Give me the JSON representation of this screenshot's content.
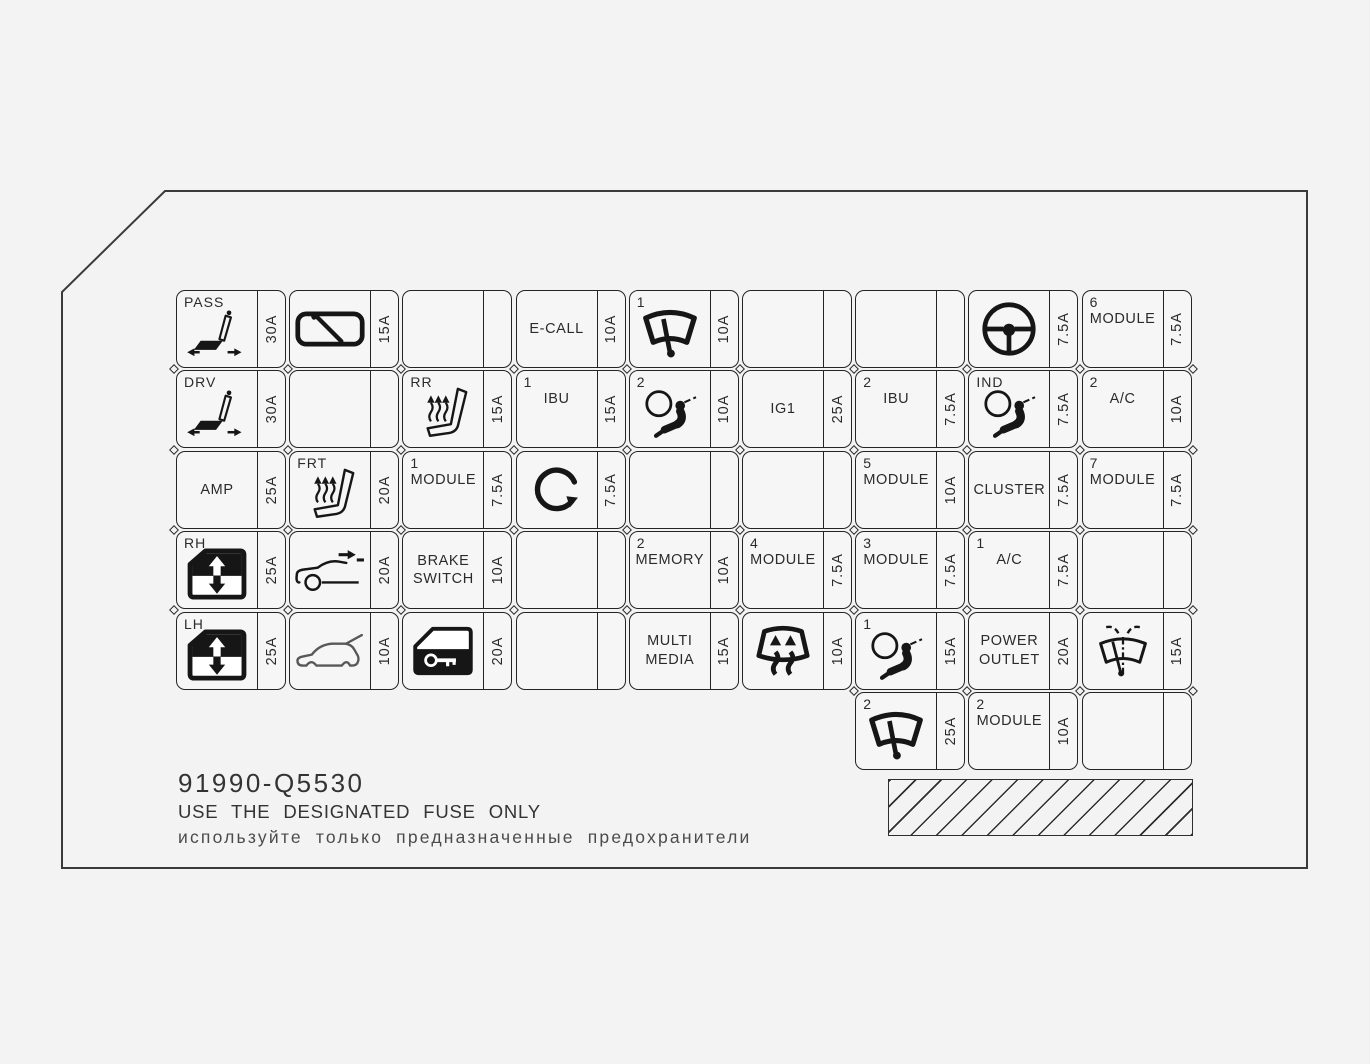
{
  "footer": {
    "part_number": "91990-Q5530",
    "warning_en": "USE THE DESIGNATED FUSE ONLY",
    "warning_ru": "используйте только предназначенные предохранители"
  },
  "colors": {
    "line": "#2a2a2a",
    "background": "#f3f3f4"
  },
  "fuse_grid": {
    "columns": 9,
    "rows": [
      {
        "cells": [
          {
            "col": 1,
            "tag": "PASS",
            "icon": "power-seat-icon",
            "amp": "30A"
          },
          {
            "col": 2,
            "icon": "wiper-blade-icon",
            "amp": "15A"
          },
          {
            "col": 3,
            "amp": ""
          },
          {
            "col": 4,
            "label": "E-CALL",
            "amp": "10A"
          },
          {
            "col": 5,
            "tag": "1",
            "icon": "front-wiper-icon",
            "amp": "10A"
          },
          {
            "col": 6,
            "amp": ""
          },
          {
            "col": 7,
            "amp": ""
          },
          {
            "col": 8,
            "icon": "steering-wheel-icon",
            "amp": "7.5A"
          },
          {
            "col": 9,
            "tag": "6",
            "label": "MODULE",
            "amp": "7.5A"
          }
        ]
      },
      {
        "cells": [
          {
            "col": 1,
            "tag": "DRV",
            "icon": "power-seat-icon",
            "amp": "30A"
          },
          {
            "col": 2,
            "amp": ""
          },
          {
            "col": 3,
            "tag": "RR",
            "icon": "heated-seat-icon",
            "amp": "15A"
          },
          {
            "col": 4,
            "tag": "1",
            "label": "IBU",
            "amp": "15A"
          },
          {
            "col": 5,
            "tag": "2",
            "icon": "airbag-icon",
            "amp": "10A"
          },
          {
            "col": 6,
            "label": "IG1",
            "amp": "25A"
          },
          {
            "col": 7,
            "tag": "2",
            "label": "IBU",
            "amp": "7.5A"
          },
          {
            "col": 8,
            "tag": "IND",
            "icon": "airbag-icon",
            "amp": "7.5A"
          },
          {
            "col": 9,
            "tag": "2",
            "label": "A/C",
            "amp": "10A"
          }
        ]
      },
      {
        "cells": [
          {
            "col": 1,
            "label": "AMP",
            "amp": "25A"
          },
          {
            "col": 2,
            "tag": "FRT",
            "icon": "heated-seat-icon",
            "amp": "20A"
          },
          {
            "col": 3,
            "tag": "1",
            "label": "MODULE",
            "amp": "7.5A"
          },
          {
            "col": 4,
            "icon": "rotation-arrow-icon",
            "amp": "7.5A"
          },
          {
            "col": 5,
            "amp": ""
          },
          {
            "col": 6,
            "amp": ""
          },
          {
            "col": 7,
            "tag": "5",
            "label": "MODULE",
            "amp": "10A"
          },
          {
            "col": 8,
            "label": "CLUSTER",
            "amp": "7.5A"
          },
          {
            "col": 9,
            "tag": "7",
            "label": "MODULE",
            "amp": "7.5A"
          }
        ]
      },
      {
        "cells": [
          {
            "col": 1,
            "tag": "RH",
            "icon": "power-window-icon",
            "amp": "25A"
          },
          {
            "col": 2,
            "icon": "car-forward-icon",
            "amp": "20A"
          },
          {
            "col": 3,
            "label": "BRAKE\nSWITCH",
            "amp": "10A"
          },
          {
            "col": 4,
            "amp": ""
          },
          {
            "col": 5,
            "tag": "2",
            "label": "MEMORY",
            "amp": "10A"
          },
          {
            "col": 6,
            "tag": "4",
            "label": "MODULE",
            "amp": "7.5A"
          },
          {
            "col": 7,
            "tag": "3",
            "label": "MODULE",
            "amp": "7.5A"
          },
          {
            "col": 8,
            "tag": "1",
            "label": "A/C",
            "amp": "7.5A"
          },
          {
            "col": 9,
            "amp": ""
          }
        ]
      },
      {
        "cells": [
          {
            "col": 1,
            "tag": "LH",
            "icon": "power-window-icon",
            "amp": "25A"
          },
          {
            "col": 2,
            "icon": "tailgate-icon",
            "amp": "10A"
          },
          {
            "col": 3,
            "icon": "door-lock-icon",
            "amp": "20A"
          },
          {
            "col": 4,
            "amp": ""
          },
          {
            "col": 5,
            "label": "MULTI\nMEDIA",
            "amp": "15A"
          },
          {
            "col": 6,
            "icon": "rear-defrost-icon",
            "amp": "10A"
          },
          {
            "col": 7,
            "tag": "1",
            "icon": "airbag-icon",
            "amp": "15A"
          },
          {
            "col": 8,
            "label": "POWER\nOUTLET",
            "amp": "20A"
          },
          {
            "col": 9,
            "icon": "washer-icon",
            "amp": "15A"
          }
        ]
      },
      {
        "cells": [
          {
            "col": 7,
            "tag": "2",
            "icon": "front-wiper-icon",
            "amp": "25A"
          },
          {
            "col": 8,
            "tag": "2",
            "label": "MODULE",
            "amp": "10A"
          },
          {
            "col": 9,
            "amp": ""
          }
        ]
      }
    ]
  }
}
